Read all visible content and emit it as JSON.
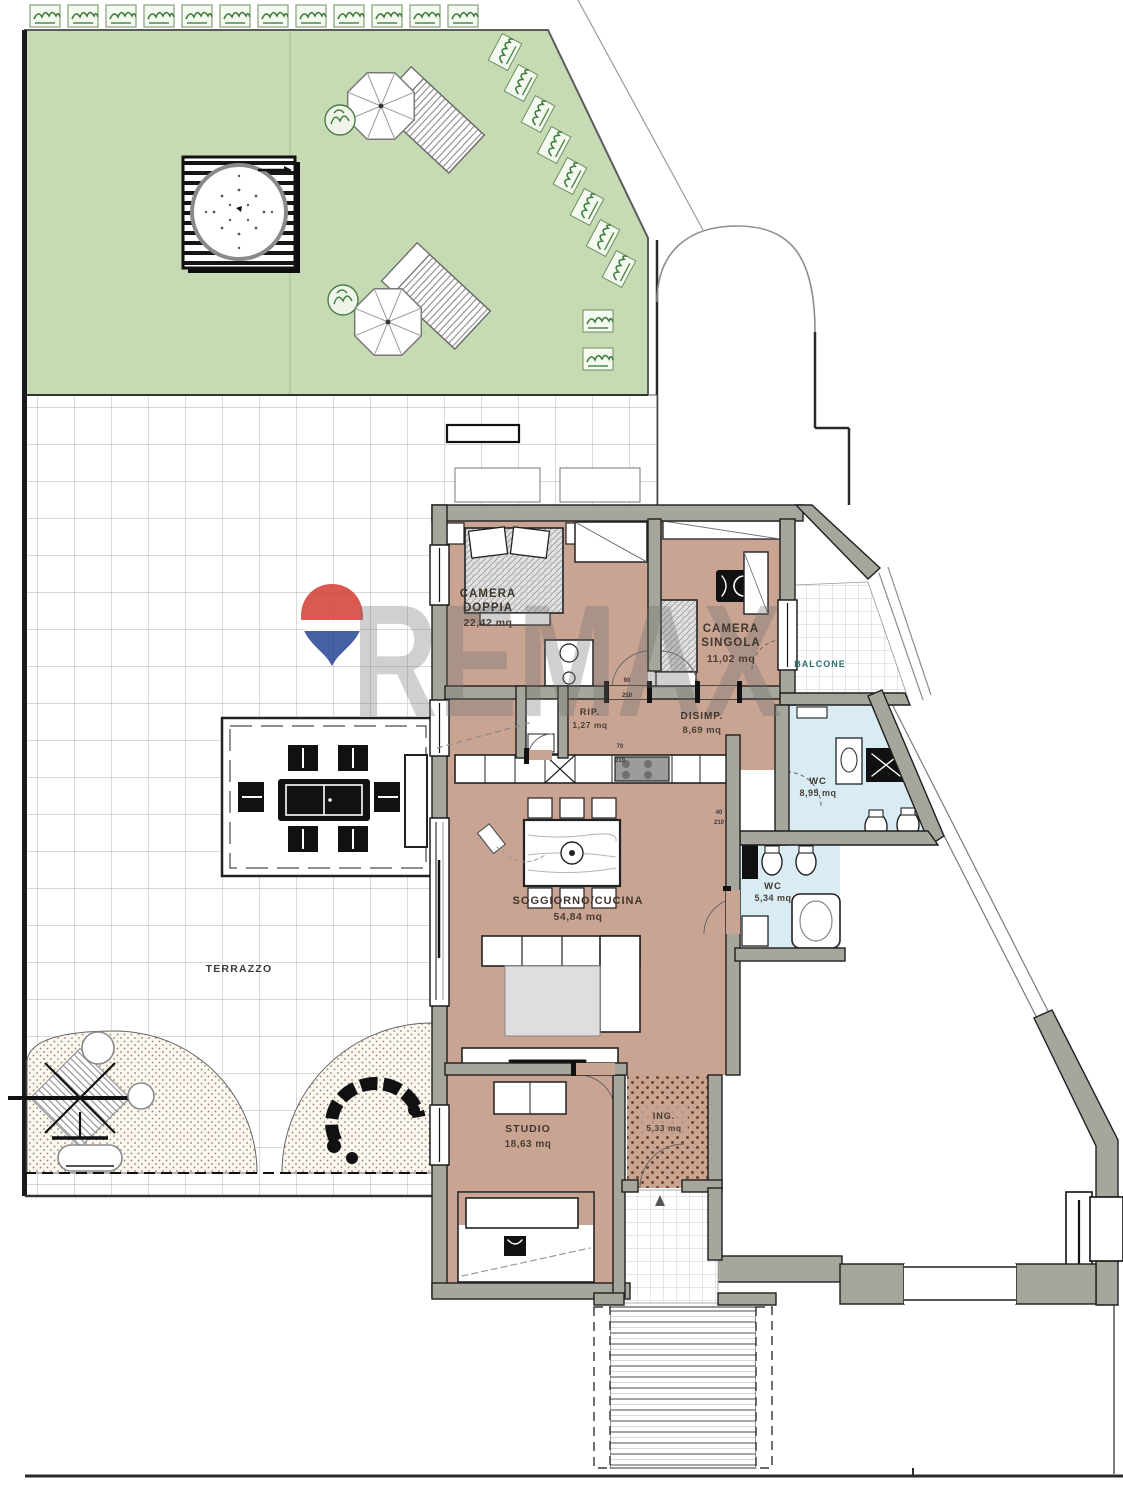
{
  "floor_plan": {
    "watermark": {
      "brand": "REMAX"
    },
    "rooms": {
      "camera_doppia": {
        "lines": [
          "CAMERA",
          "DOPPIA",
          "22,42 mq"
        ]
      },
      "camera_singola": {
        "lines": [
          "CAMERA",
          "SINGOLA",
          "11,02 mq"
        ]
      },
      "ripostiglio": {
        "lines": [
          "RIP.",
          "1,27 mq"
        ]
      },
      "disimpegno": {
        "lines": [
          "DISIMP.",
          "8,69 mq"
        ]
      },
      "wc_grande": {
        "lines": [
          "WC",
          "8,95 mq"
        ]
      },
      "wc_piccolo": {
        "lines": [
          "WC",
          "5,34 mq"
        ]
      },
      "soggiorno_cucina": {
        "lines": [
          "SOGGIORNO/CUCINA",
          "54,84 mq"
        ]
      },
      "studio": {
        "lines": [
          "STUDIO",
          "18,63 mq"
        ]
      },
      "ingresso": {
        "lines": [
          "ING.",
          "5,33 mq"
        ]
      },
      "terrazzo": {
        "lines": [
          "TERRAZZO"
        ]
      },
      "balcone": {
        "lines": [
          "BALCONE"
        ]
      }
    },
    "door_annotations": [
      {
        "width": "90",
        "height": "210"
      },
      {
        "width": "70",
        "height": "210"
      },
      {
        "width": "40",
        "height": "210"
      }
    ],
    "colors": {
      "garden": "#c6dbb4",
      "floor_tan": "#c9a492",
      "wall_gray": "#a6a69c",
      "bath_blue": "#d9ecf4",
      "balloon_red": "#d3362d",
      "balloon_blue": "#1d3e8f"
    }
  }
}
